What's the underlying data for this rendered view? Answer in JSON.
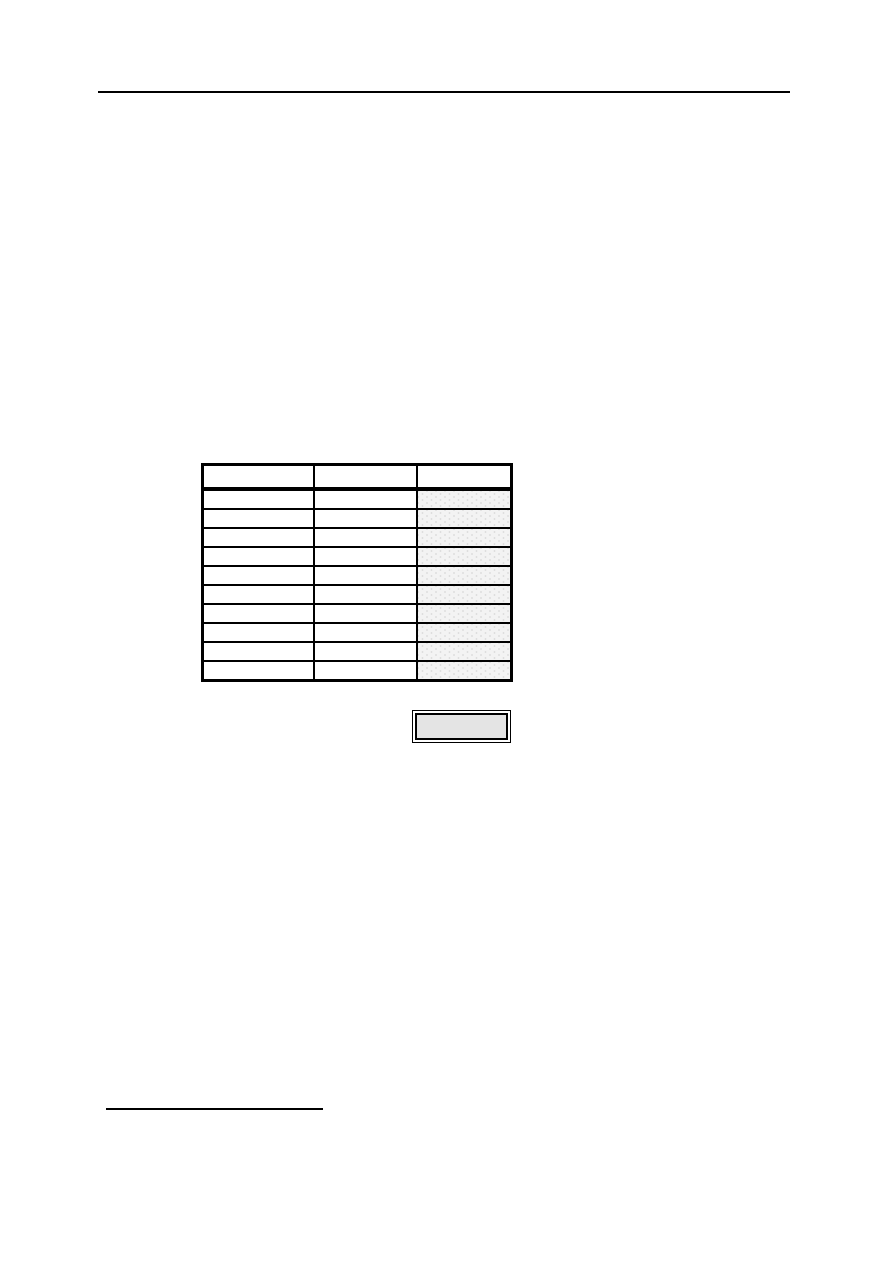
{
  "page": {
    "background": "#ffffff"
  },
  "header_rule": {
    "color": "#000000"
  },
  "table": {
    "border_color": "#000000",
    "header_labels": [
      "",
      "",
      ""
    ],
    "rows": [
      [
        "",
        "",
        ""
      ],
      [
        "",
        "",
        ""
      ],
      [
        "",
        "",
        ""
      ],
      [
        "",
        "",
        ""
      ],
      [
        "",
        "",
        ""
      ],
      [
        "",
        "",
        ""
      ],
      [
        "",
        "",
        ""
      ],
      [
        "",
        "",
        ""
      ],
      [
        "",
        "",
        ""
      ],
      [
        "",
        "",
        ""
      ]
    ],
    "shaded_column_index": 2,
    "shaded_cell_background": "#f3f3f3",
    "shaded_cell_dot_color": "#dedede"
  },
  "summary_box": {
    "label": "",
    "fill_color": "#e4e4e4",
    "border_color": "#000000"
  },
  "footnote_rule": {
    "color": "#000000"
  }
}
